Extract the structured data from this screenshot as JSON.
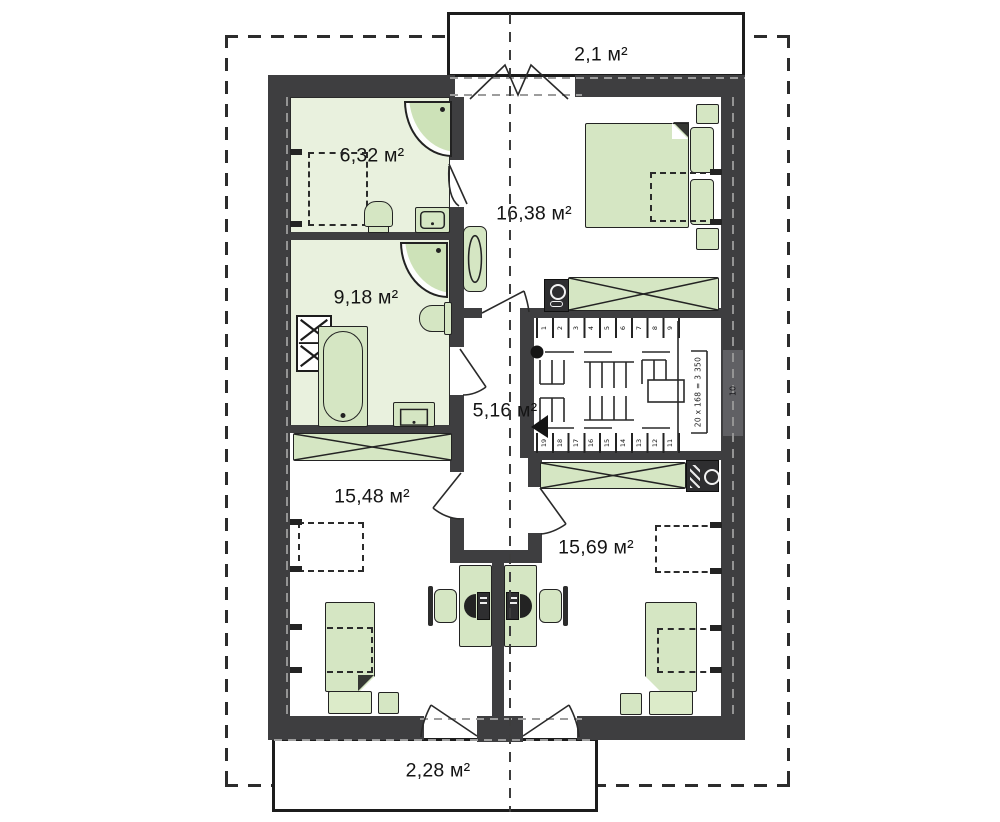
{
  "plan": {
    "areas": {
      "balcony_top": "2,1 м²",
      "bath_top": "6,32 м²",
      "bedroom_right": "16,38 м²",
      "bath_mid": "9,18 м²",
      "hall": "5,16 м²",
      "room_bottom_left": "15,48 м²",
      "room_bottom_right": "15,69 м²",
      "balcony_bottom": "2,28 м²"
    },
    "stairs": {
      "up_steps": [
        "1",
        "2",
        "3",
        "4",
        "5",
        "6",
        "7",
        "8",
        "9"
      ],
      "down_steps": [
        "19",
        "18",
        "17",
        "16",
        "15",
        "14",
        "13",
        "12",
        "11"
      ],
      "landing_step": "10",
      "formula": "20 x 168 = 3 350"
    },
    "colors": {
      "wall": "#3e3e40",
      "furniture": "#d5e6c3",
      "bath_floor": "#e9f1de",
      "line": "#2a2a2a"
    }
  }
}
